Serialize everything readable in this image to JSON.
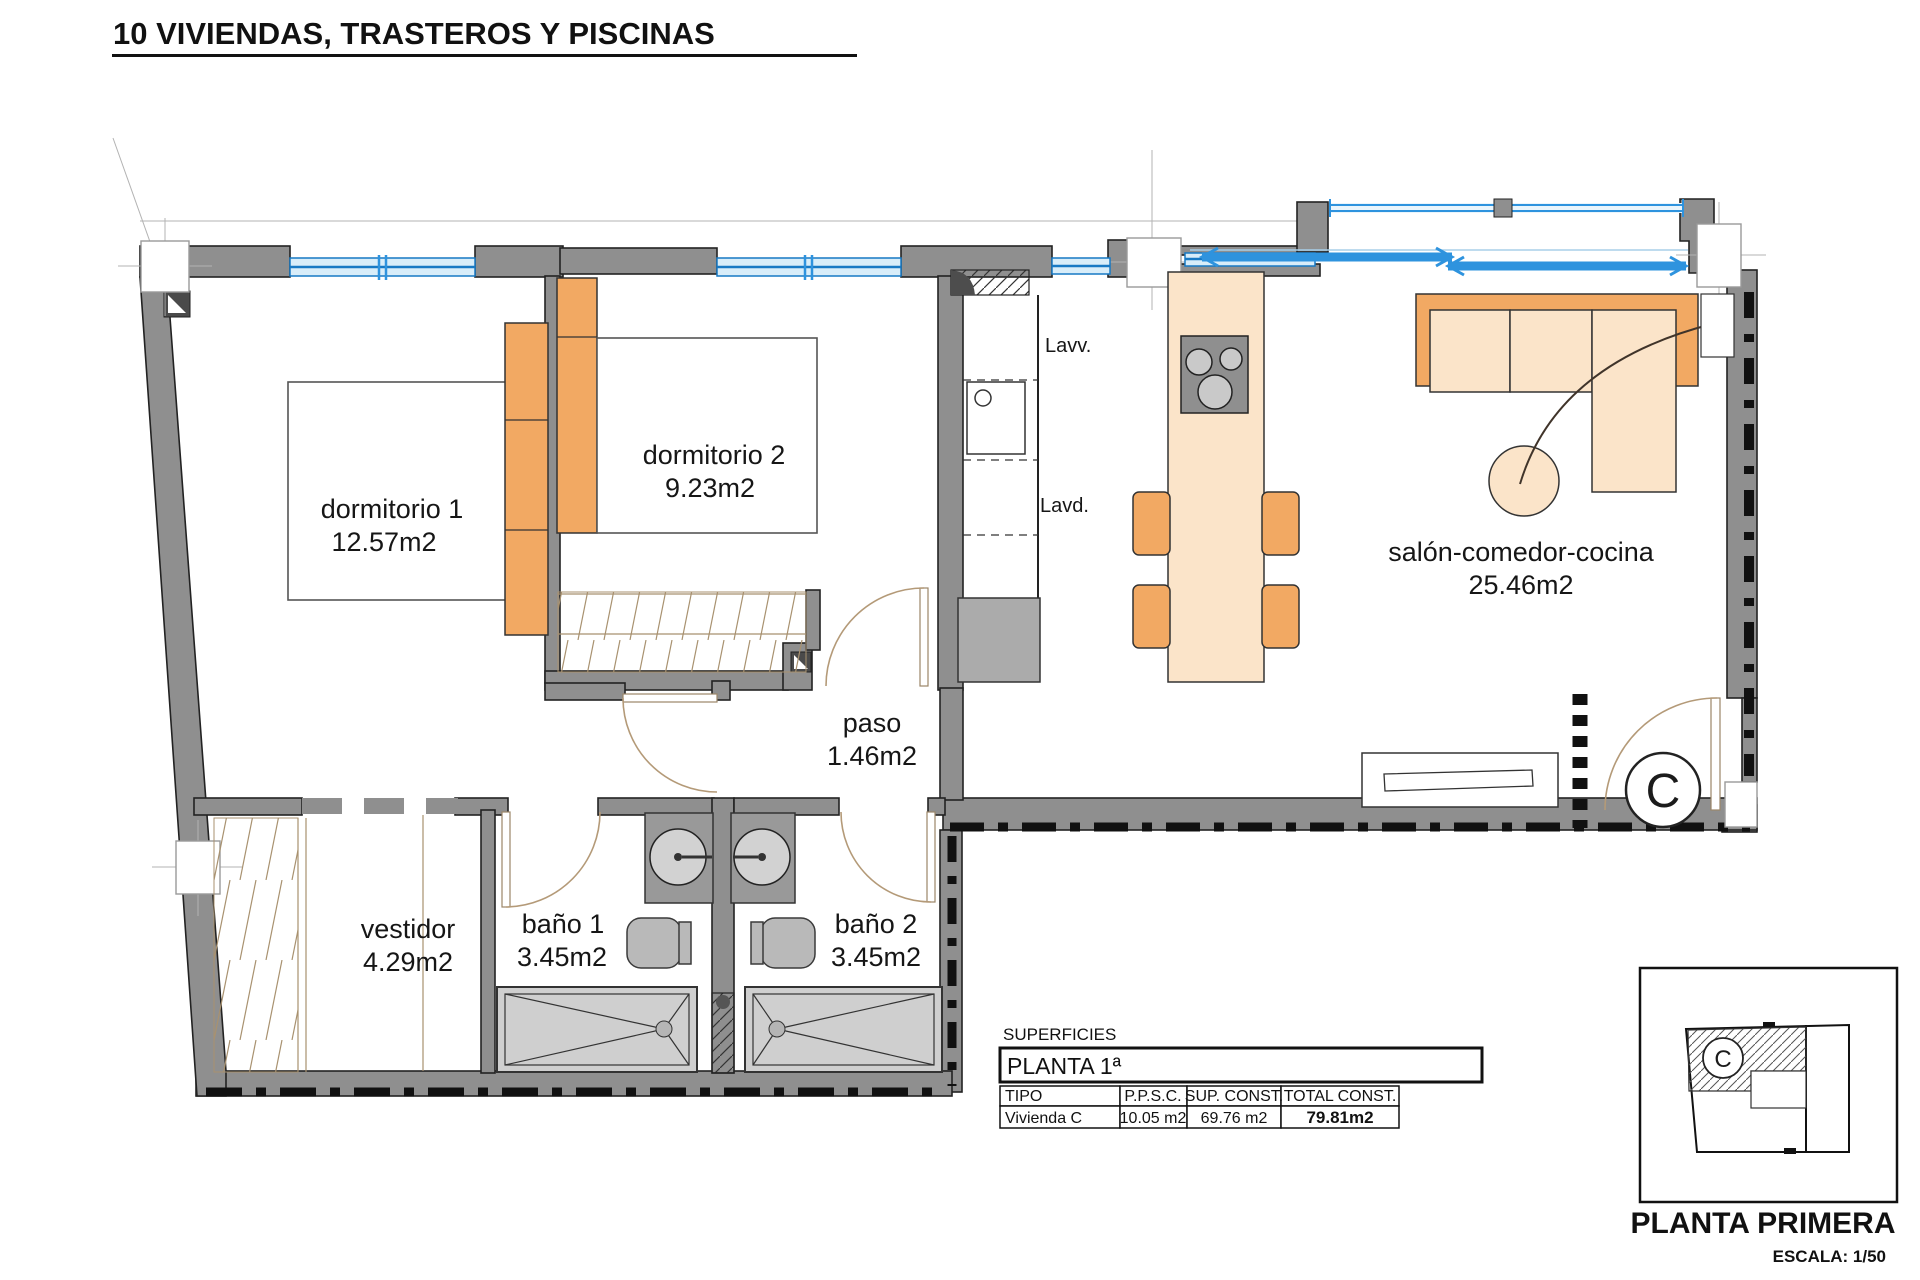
{
  "title": "10 VIVIENDAS, TRASTEROS Y PISCINAS",
  "plan": {
    "rooms": [
      {
        "name": "dormitorio 1",
        "area": "12.57m2"
      },
      {
        "name": "dormitorio 2",
        "area": "9.23m2"
      },
      {
        "name": "salón-comedor-cocina",
        "area": "25.46m2"
      },
      {
        "name": "paso",
        "area": "1.46m2"
      },
      {
        "name": "vestidor",
        "area": "4.29m2"
      },
      {
        "name": "baño 1",
        "area": "3.45m2"
      },
      {
        "name": "baño 2",
        "area": "3.45m2"
      }
    ],
    "labels": {
      "washbasin": "Lavv.",
      "laundry": "Lavd."
    },
    "unit_letter": "C"
  },
  "surfaces": {
    "caption": "SUPERFICIES",
    "floor": "PLANTA 1ª",
    "columns": [
      "TIPO",
      "P.P.S.C.",
      "SUP. CONST.",
      "TOTAL CONST."
    ],
    "row": {
      "tipo": "Vivienda C",
      "ppsc": "10.05 m2",
      "sup_const": "69.76 m2",
      "total_const": "79.81m2"
    }
  },
  "key_plan": {
    "unit_letter": "C",
    "title": "PLANTA PRIMERA",
    "scale": "ESCALA: 1/50"
  },
  "colors": {
    "wall": "#8f8f8f",
    "outline": "#222222",
    "furniture_orange": "#f2a963",
    "furniture_cream": "#fbe4c9",
    "fixture_gray": "#b9b9b9",
    "window_blue": "#2e93de",
    "window_fill": "#d8edf9",
    "door_arc": "#b49a78",
    "dash": "#111111"
  }
}
